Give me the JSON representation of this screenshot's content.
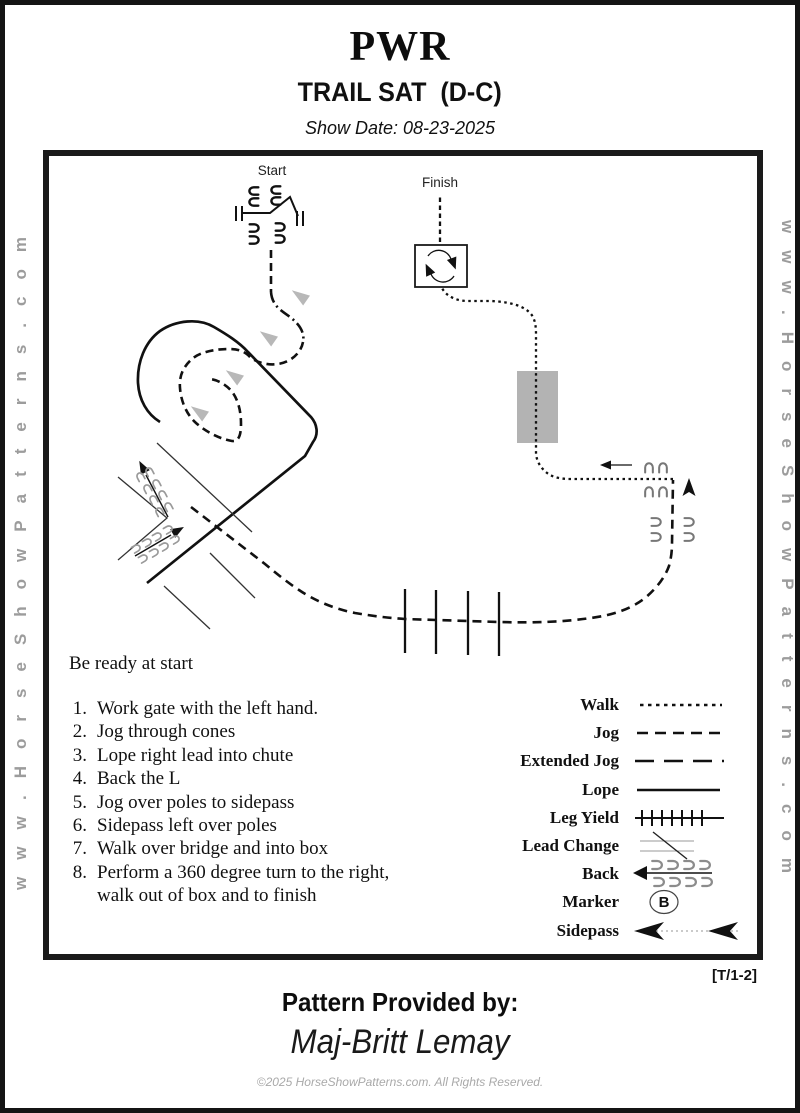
{
  "page": {
    "title": "PWR",
    "subtitle": "TRAIL SAT  (D-C)",
    "show_date": "Show Date: 08-23-2025",
    "watermark": "www.HorseShowPatterns.com",
    "pattern_code": "[T/1-2]",
    "provided_by_label": "Pattern Provided by:",
    "provided_by_name": "Maj-Britt Lemay",
    "copyright": "©2025 HorseShowPatterns.com. All Rights Reserved."
  },
  "diagram": {
    "start_label": "Start",
    "finish_label": "Finish",
    "marker_letter": "B",
    "colors": {
      "ink": "#111111",
      "gray_prints": "#999999",
      "bridge": "#b3b3b3",
      "cone": "#b8b8b8"
    }
  },
  "instructions": {
    "ready_note": "Be ready at start",
    "items": [
      {
        "num": "1.",
        "text": "Work gate with the left hand."
      },
      {
        "num": "2.",
        "text": "Jog through cones"
      },
      {
        "num": "3.",
        "text": "Lope right lead into chute"
      },
      {
        "num": "4.",
        "text": "Back the L"
      },
      {
        "num": "5.",
        "text": "Jog over poles to sidepass"
      },
      {
        "num": "6.",
        "text": "Sidepass left over poles"
      },
      {
        "num": "7.",
        "text": "Walk over bridge and into box"
      },
      {
        "num": "8.",
        "text": "Perform a 360 degree turn to the right,"
      },
      {
        "num": "",
        "text": "walk out of  box and to finish"
      }
    ]
  },
  "legend": {
    "items": [
      {
        "label": "Walk"
      },
      {
        "label": "Jog"
      },
      {
        "label": "Extended Jog"
      },
      {
        "label": "Lope"
      },
      {
        "label": "Leg Yield"
      },
      {
        "label": "Lead Change"
      },
      {
        "label": "Back"
      },
      {
        "label": "Marker"
      },
      {
        "label": "Sidepass"
      }
    ]
  }
}
